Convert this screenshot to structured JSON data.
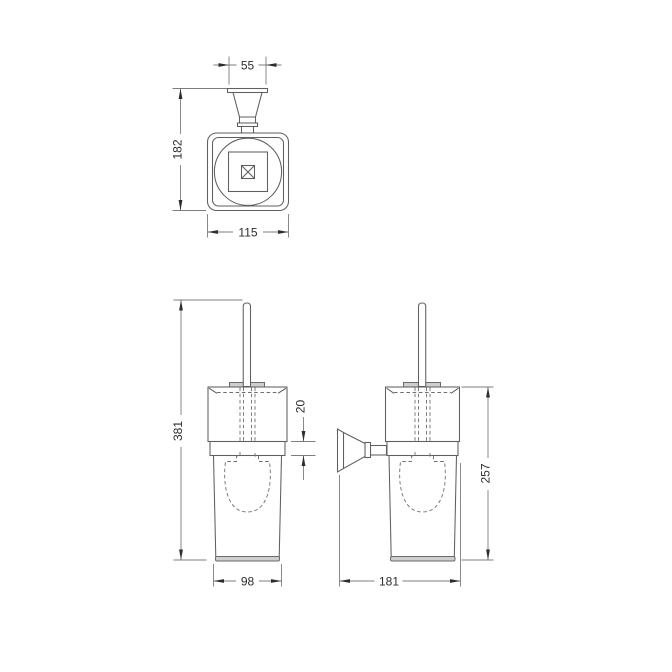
{
  "drawing": {
    "title": "toilet brush holder dimension drawing",
    "colors": {
      "background": "#ffffff",
      "object_line": "#5f5f5f",
      "dimension_line": "#7d7d7d",
      "hidden_line": "#6f6f6f",
      "arrow_and_text": "#2d2d2d",
      "light_fill": "#cfcfcf"
    },
    "views": {
      "top": {
        "label": "top view",
        "dims": {
          "bracket_width": "55",
          "overall_height": "182",
          "body_width": "115"
        }
      },
      "front": {
        "label": "front view",
        "dims": {
          "overall_height": "381",
          "collar_height": "20",
          "cup_width": "98"
        }
      },
      "side": {
        "label": "side view",
        "dims": {
          "holder_height": "257",
          "wall_depth": "181"
        }
      }
    }
  }
}
